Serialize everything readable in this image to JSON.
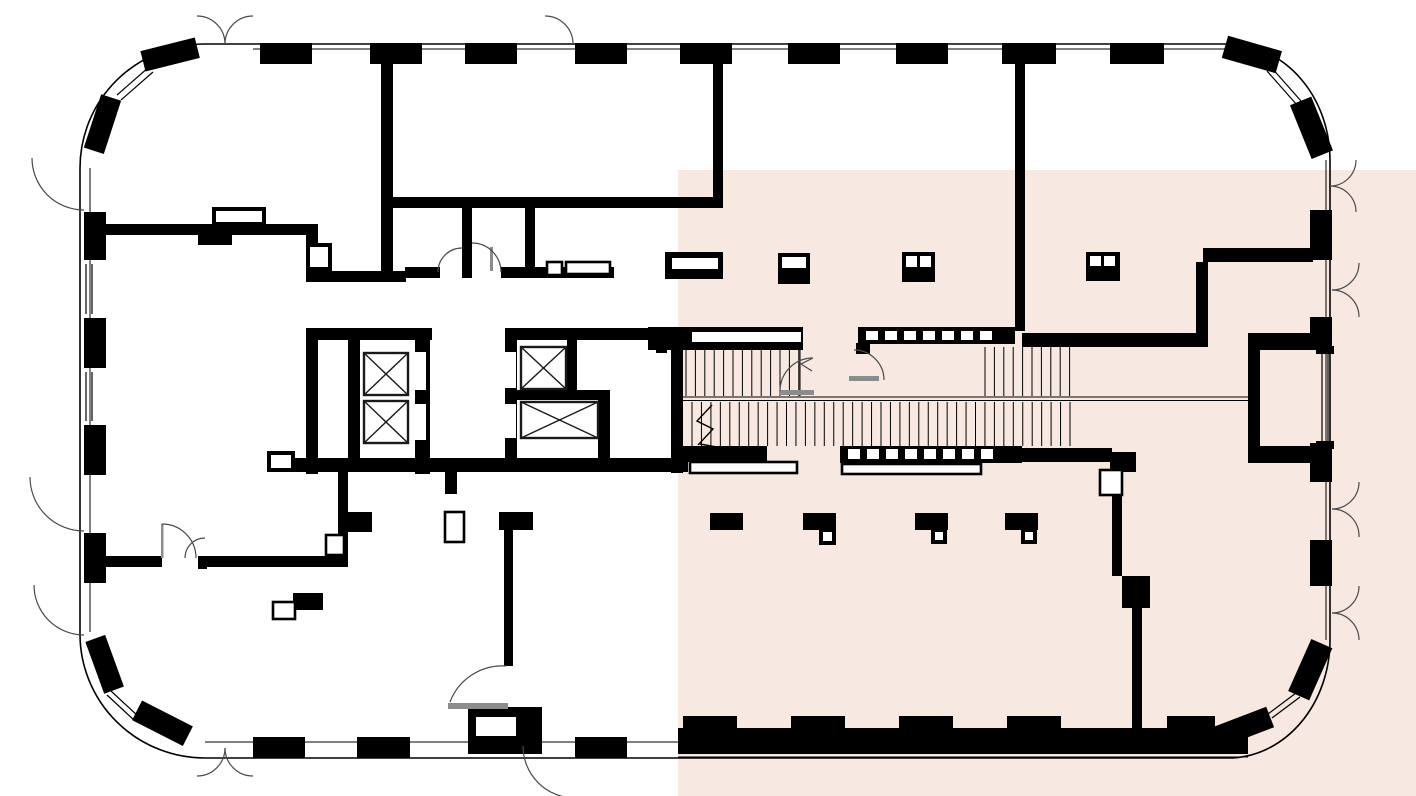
{
  "plan": {
    "background_color": "#ffffff",
    "line_color": "#000000",
    "highlight_color": "#f7e9e1",
    "door_arc_color": "#4a4a4a",
    "door_leaf_color": "#8c8c8c",
    "elevator_count": 4,
    "stair_flight_count": 2
  }
}
